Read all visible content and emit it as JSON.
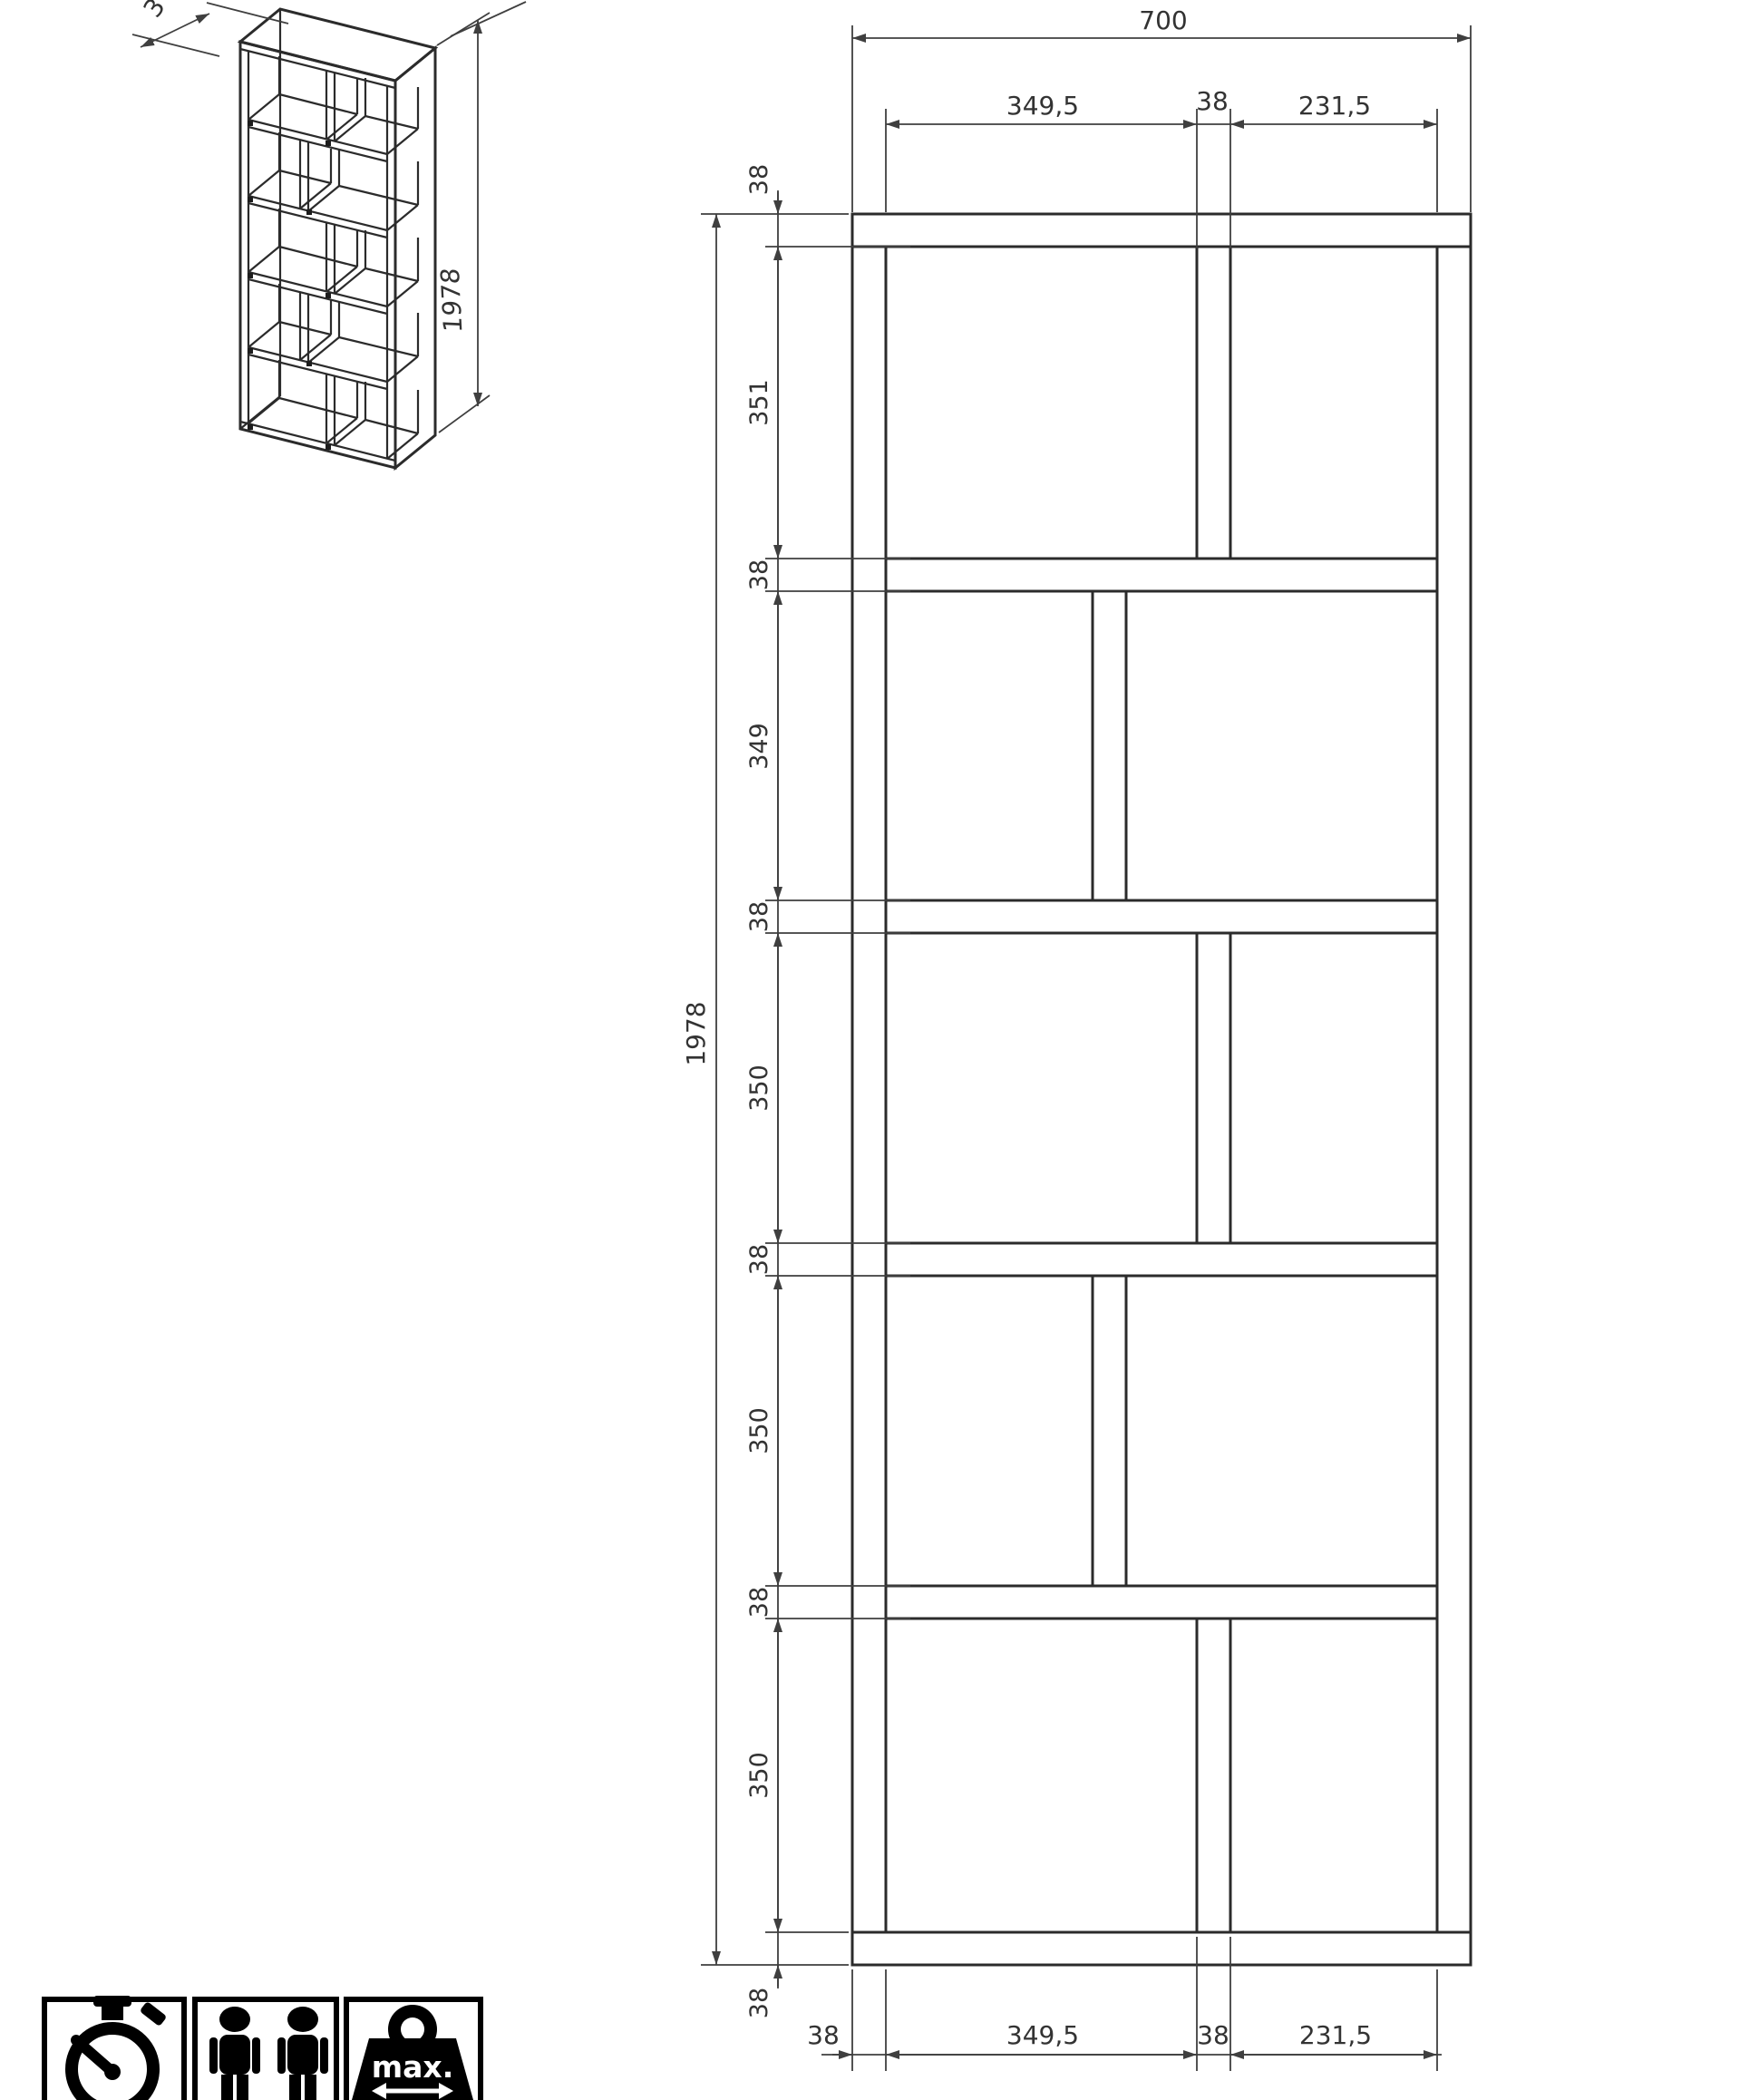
{
  "colors": {
    "background": "#ffffff",
    "part_line": "#2b2b2b",
    "dimension_line": "#3f3f3f",
    "dimension_text": "#333333",
    "icon": "#000000"
  },
  "front_view": {
    "overall_width": "700",
    "overall_height": "1978",
    "top_chain": [
      "349,5",
      "38",
      "231,5"
    ],
    "left_chain": [
      "38",
      "351",
      "38",
      "349",
      "38",
      "350",
      "38",
      "350",
      "38",
      "350",
      "38"
    ],
    "bottom_chain": [
      "38",
      "349,5",
      "38",
      "231,5"
    ]
  },
  "iso_view": {
    "height_label": "1978",
    "depth_label_partial": "3"
  },
  "badges": {
    "icons": [
      "stopwatch-icon",
      "two-persons-icon",
      "max-weight-icon"
    ],
    "weight_label": "max."
  }
}
